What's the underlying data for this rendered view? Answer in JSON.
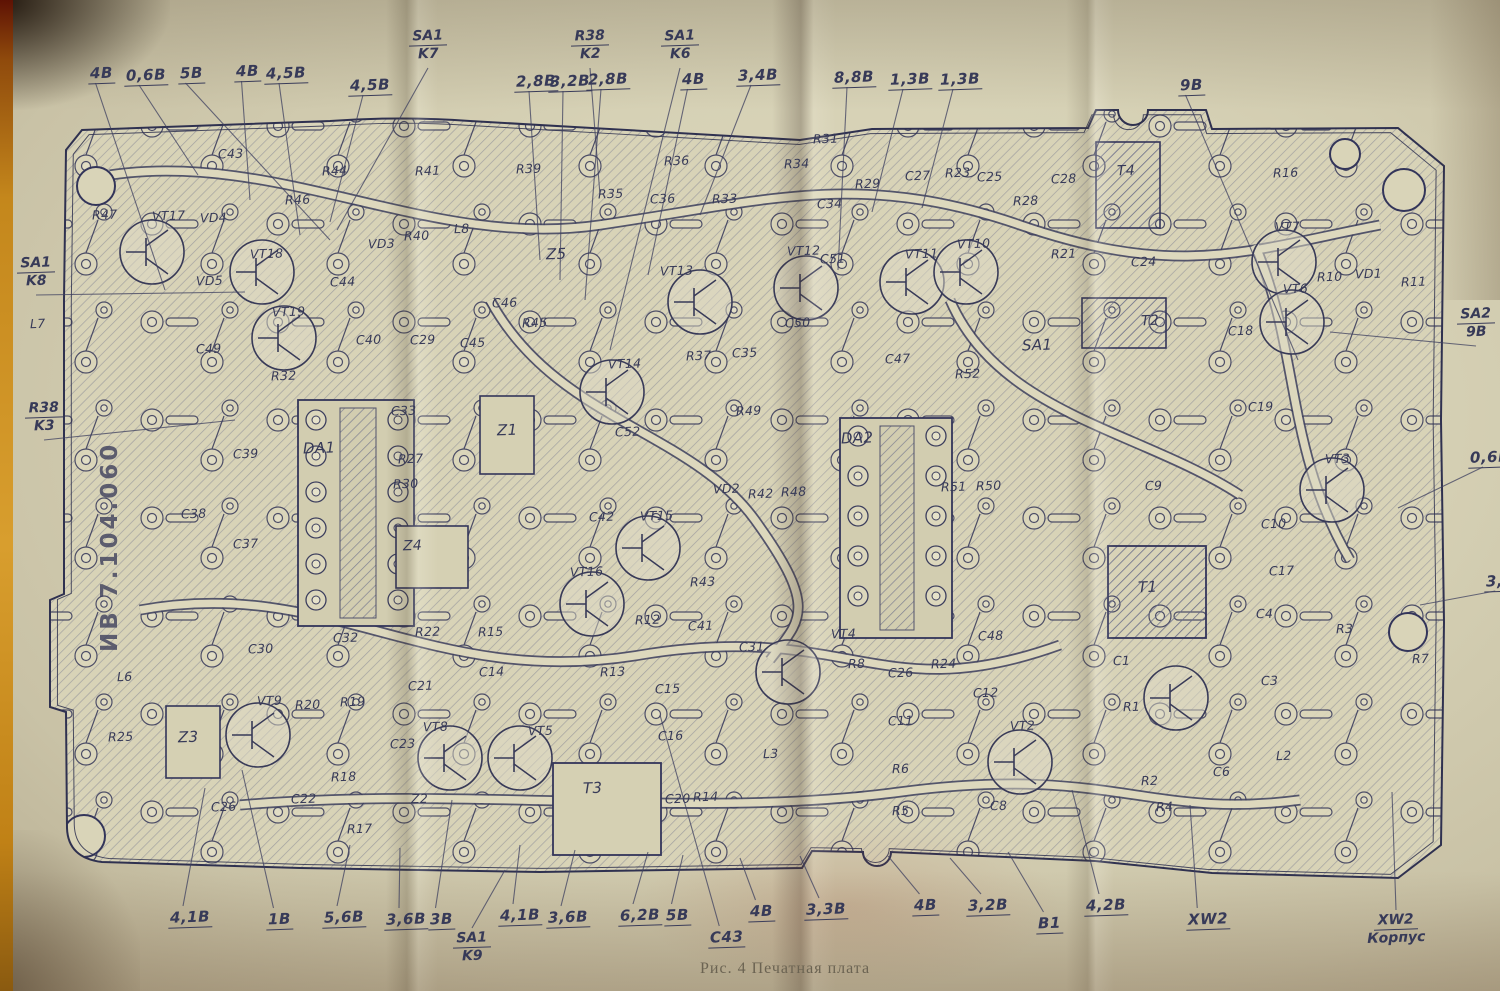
{
  "caption": "Рис. 4 Печатная плата",
  "board_id": "ИВ 7.104.060",
  "colors": {
    "paper": "#d6d0b4",
    "ink": "#373a58",
    "copper_hatch": "#6b6e8a",
    "film_strip_orange": "#c4871c"
  },
  "voltage_labels": [
    {
      "t": "4В",
      "x": 88,
      "y": 64,
      "lx": 165,
      "ly": 290
    },
    {
      "t": "0,6В",
      "x": 124,
      "y": 66,
      "lx": 198,
      "ly": 175
    },
    {
      "t": "5В",
      "x": 178,
      "y": 64,
      "lx": 330,
      "ly": 240
    },
    {
      "t": "4В",
      "x": 234,
      "y": 62,
      "lx": 250,
      "ly": 200
    },
    {
      "t": "4,5В",
      "x": 264,
      "y": 64,
      "lx": 300,
      "ly": 235
    },
    {
      "t": "4,5В",
      "x": 348,
      "y": 76,
      "lx": 330,
      "ly": 222
    },
    {
      "t": "2,8В",
      "x": 514,
      "y": 72,
      "lx": 540,
      "ly": 260
    },
    {
      "t": "3,2В",
      "x": 548,
      "y": 72,
      "lx": 560,
      "ly": 280
    },
    {
      "t": "2,8В",
      "x": 586,
      "y": 70,
      "lx": 585,
      "ly": 300
    },
    {
      "t": "4В",
      "x": 680,
      "y": 70,
      "lx": 648,
      "ly": 275
    },
    {
      "t": "3,4В",
      "x": 736,
      "y": 66,
      "lx": 700,
      "ly": 215
    },
    {
      "t": "8,8В",
      "x": 832,
      "y": 68,
      "lx": 838,
      "ly": 270
    },
    {
      "t": "1,3В",
      "x": 888,
      "y": 70,
      "lx": 872,
      "ly": 212
    },
    {
      "t": "1,3В",
      "x": 938,
      "y": 70,
      "lx": 922,
      "ly": 208
    },
    {
      "t": "9В",
      "x": 1178,
      "y": 76,
      "lx": 1298,
      "ly": 360
    },
    {
      "t": "0,6В",
      "x": 1468,
      "y": 448,
      "lx": 1398,
      "ly": 508
    },
    {
      "t": "3,6",
      "x": 1484,
      "y": 572,
      "lx": 1420,
      "ly": 605
    },
    {
      "t": "4,1В",
      "x": 168,
      "y": 908,
      "lx": 205,
      "ly": 788
    },
    {
      "t": "1В",
      "x": 266,
      "y": 910,
      "lx": 242,
      "ly": 770
    },
    {
      "t": "5,6В",
      "x": 322,
      "y": 908,
      "lx": 350,
      "ly": 845
    },
    {
      "t": "3,6В",
      "x": 384,
      "y": 910,
      "lx": 400,
      "ly": 848
    },
    {
      "t": "3В",
      "x": 428,
      "y": 910,
      "lx": 452,
      "ly": 800
    },
    {
      "t": "4,1В",
      "x": 498,
      "y": 906,
      "lx": 520,
      "ly": 845
    },
    {
      "t": "3,6В",
      "x": 546,
      "y": 908,
      "lx": 575,
      "ly": 850
    },
    {
      "t": "6,2В",
      "x": 618,
      "y": 906,
      "lx": 648,
      "ly": 852
    },
    {
      "t": "5В",
      "x": 664,
      "y": 906,
      "lx": 683,
      "ly": 855
    },
    {
      "t": "C43",
      "x": 708,
      "y": 928,
      "lx": 660,
      "ly": 715
    },
    {
      "t": "4В",
      "x": 748,
      "y": 902,
      "lx": 740,
      "ly": 858
    },
    {
      "t": "3,3В",
      "x": 804,
      "y": 900,
      "lx": 800,
      "ly": 856
    },
    {
      "t": "4В",
      "x": 912,
      "y": 896,
      "lx": 888,
      "ly": 856
    },
    {
      "t": "3,2В",
      "x": 966,
      "y": 896,
      "lx": 950,
      "ly": 858
    },
    {
      "t": "В1",
      "x": 1036,
      "y": 914,
      "lx": 1008,
      "ly": 852
    },
    {
      "t": "4,2В",
      "x": 1084,
      "y": 896,
      "lx": 1072,
      "ly": 790
    },
    {
      "t": "XW2",
      "x": 1186,
      "y": 910,
      "lx": 1190,
      "ly": 805
    }
  ],
  "fraction_labels": [
    {
      "top": "SA1",
      "bottom": "K7",
      "x": 404,
      "y": 28,
      "lx": 337,
      "ly": 230
    },
    {
      "top": "R38",
      "bottom": "K2",
      "x": 566,
      "y": 28,
      "lx": 600,
      "ly": 195
    },
    {
      "top": "SA1",
      "bottom": "K6",
      "x": 656,
      "y": 28,
      "lx": 610,
      "ly": 350
    },
    {
      "top": "SA1",
      "bottom": "K8",
      "x": 12,
      "y": 255,
      "lx": 245,
      "ly": 292
    },
    {
      "top": "R38",
      "bottom": "K3",
      "x": 20,
      "y": 400,
      "lx": 235,
      "ly": 420
    },
    {
      "top": "SA2",
      "bottom": "9В",
      "x": 1452,
      "y": 306,
      "lx": 1330,
      "ly": 332
    },
    {
      "top": "SA1",
      "bottom": "K9",
      "x": 448,
      "y": 930,
      "lx": 505,
      "ly": 870
    },
    {
      "top": "XW2",
      "bottom": "Корпус",
      "x": 1372,
      "y": 912,
      "lx": 1392,
      "ly": 792
    }
  ],
  "component_labels": [
    {
      "t": "C43",
      "x": 218,
      "y": 146
    },
    {
      "t": "R44",
      "x": 322,
      "y": 163
    },
    {
      "t": "R46",
      "x": 285,
      "y": 192
    },
    {
      "t": "R41",
      "x": 415,
      "y": 163
    },
    {
      "t": "R47",
      "x": 92,
      "y": 207
    },
    {
      "t": "VT17",
      "x": 152,
      "y": 208
    },
    {
      "t": "VD4",
      "x": 200,
      "y": 210
    },
    {
      "t": "VT18",
      "x": 250,
      "y": 246
    },
    {
      "t": "VD5",
      "x": 196,
      "y": 273
    },
    {
      "t": "VD3",
      "x": 368,
      "y": 236
    },
    {
      "t": "R40",
      "x": 404,
      "y": 228
    },
    {
      "t": "C44",
      "x": 330,
      "y": 274
    },
    {
      "t": "VT19",
      "x": 272,
      "y": 304
    },
    {
      "t": "C49",
      "x": 196,
      "y": 341
    },
    {
      "t": "C40",
      "x": 356,
      "y": 332
    },
    {
      "t": "C29",
      "x": 410,
      "y": 332
    },
    {
      "t": "R32",
      "x": 271,
      "y": 368
    },
    {
      "t": "L7",
      "x": 30,
      "y": 316
    },
    {
      "t": "R39",
      "x": 516,
      "y": 161
    },
    {
      "t": "R36",
      "x": 664,
      "y": 153
    },
    {
      "t": "R34",
      "x": 784,
      "y": 156
    },
    {
      "t": "R35",
      "x": 598,
      "y": 186
    },
    {
      "t": "C36",
      "x": 650,
      "y": 191
    },
    {
      "t": "R33",
      "x": 712,
      "y": 191
    },
    {
      "t": "L8",
      "x": 454,
      "y": 221
    },
    {
      "t": "Z5",
      "x": 546,
      "y": 245,
      "s": 15
    },
    {
      "t": "VT13",
      "x": 660,
      "y": 263
    },
    {
      "t": "VT12",
      "x": 787,
      "y": 243
    },
    {
      "t": "C46",
      "x": 492,
      "y": 295
    },
    {
      "t": "R45",
      "x": 522,
      "y": 315
    },
    {
      "t": "C45",
      "x": 460,
      "y": 335
    },
    {
      "t": "VT14",
      "x": 608,
      "y": 356
    },
    {
      "t": "R37",
      "x": 686,
      "y": 348
    },
    {
      "t": "C35",
      "x": 732,
      "y": 345
    },
    {
      "t": "C50",
      "x": 785,
      "y": 315
    },
    {
      "t": "R49",
      "x": 736,
      "y": 403
    },
    {
      "t": "R31",
      "x": 813,
      "y": 131
    },
    {
      "t": "R29",
      "x": 855,
      "y": 176
    },
    {
      "t": "C27",
      "x": 905,
      "y": 168
    },
    {
      "t": "R23",
      "x": 945,
      "y": 165
    },
    {
      "t": "C25",
      "x": 977,
      "y": 169
    },
    {
      "t": "C28",
      "x": 1051,
      "y": 171
    },
    {
      "t": "T4",
      "x": 1117,
      "y": 163,
      "s": 14
    },
    {
      "t": "C34",
      "x": 817,
      "y": 196
    },
    {
      "t": "R28",
      "x": 1013,
      "y": 193
    },
    {
      "t": "VT11",
      "x": 905,
      "y": 246
    },
    {
      "t": "VT10",
      "x": 957,
      "y": 236
    },
    {
      "t": "R21",
      "x": 1051,
      "y": 246
    },
    {
      "t": "C51",
      "x": 820,
      "y": 251
    },
    {
      "t": "C24",
      "x": 1131,
      "y": 254
    },
    {
      "t": "T2",
      "x": 1141,
      "y": 313,
      "s": 14
    },
    {
      "t": "SA1",
      "x": 1022,
      "y": 336,
      "s": 15
    },
    {
      "t": "C47",
      "x": 885,
      "y": 351
    },
    {
      "t": "R52",
      "x": 955,
      "y": 366
    },
    {
      "t": "R16",
      "x": 1273,
      "y": 165
    },
    {
      "t": "VT7",
      "x": 1275,
      "y": 219
    },
    {
      "t": "R10",
      "x": 1317,
      "y": 269
    },
    {
      "t": "VD1",
      "x": 1355,
      "y": 266
    },
    {
      "t": "R11",
      "x": 1401,
      "y": 274
    },
    {
      "t": "VT6",
      "x": 1283,
      "y": 281
    },
    {
      "t": "C18",
      "x": 1228,
      "y": 323
    },
    {
      "t": "C33",
      "x": 391,
      "y": 403
    },
    {
      "t": "DA1",
      "x": 303,
      "y": 439,
      "s": 15
    },
    {
      "t": "C39",
      "x": 233,
      "y": 446
    },
    {
      "t": "R27",
      "x": 398,
      "y": 451
    },
    {
      "t": "R30",
      "x": 393,
      "y": 476
    },
    {
      "t": "C38",
      "x": 181,
      "y": 506
    },
    {
      "t": "Z1",
      "x": 497,
      "y": 421,
      "s": 15
    },
    {
      "t": "C37",
      "x": 233,
      "y": 536
    },
    {
      "t": "Z4",
      "x": 403,
      "y": 538,
      "s": 14
    },
    {
      "t": "C52",
      "x": 615,
      "y": 424
    },
    {
      "t": "DA2",
      "x": 841,
      "y": 429,
      "s": 15
    },
    {
      "t": "VD2",
      "x": 713,
      "y": 481
    },
    {
      "t": "R42",
      "x": 748,
      "y": 486
    },
    {
      "t": "R48",
      "x": 781,
      "y": 484
    },
    {
      "t": "C42",
      "x": 589,
      "y": 509
    },
    {
      "t": "VT15",
      "x": 640,
      "y": 508
    },
    {
      "t": "VT16",
      "x": 570,
      "y": 564
    },
    {
      "t": "R43",
      "x": 690,
      "y": 574
    },
    {
      "t": "R12",
      "x": 635,
      "y": 612
    },
    {
      "t": "C41",
      "x": 688,
      "y": 618
    },
    {
      "t": "C31",
      "x": 739,
      "y": 639
    },
    {
      "t": "VT4",
      "x": 831,
      "y": 626
    },
    {
      "t": "R13",
      "x": 600,
      "y": 664
    },
    {
      "t": "C15",
      "x": 655,
      "y": 681
    },
    {
      "t": "C16",
      "x": 658,
      "y": 728
    },
    {
      "t": "R51",
      "x": 941,
      "y": 479
    },
    {
      "t": "R50",
      "x": 976,
      "y": 478
    },
    {
      "t": "C9",
      "x": 1145,
      "y": 478
    },
    {
      "t": "C10",
      "x": 1261,
      "y": 516
    },
    {
      "t": "T1",
      "x": 1138,
      "y": 578,
      "s": 15
    },
    {
      "t": "C19",
      "x": 1248,
      "y": 399
    },
    {
      "t": "VT3",
      "x": 1325,
      "y": 451
    },
    {
      "t": "C17",
      "x": 1269,
      "y": 563
    },
    {
      "t": "C4",
      "x": 1256,
      "y": 606
    },
    {
      "t": "R3",
      "x": 1336,
      "y": 621
    },
    {
      "t": "R7",
      "x": 1412,
      "y": 651
    },
    {
      "t": "C30",
      "x": 248,
      "y": 641
    },
    {
      "t": "C32",
      "x": 333,
      "y": 630
    },
    {
      "t": "R22",
      "x": 415,
      "y": 624
    },
    {
      "t": "R15",
      "x": 478,
      "y": 624
    },
    {
      "t": "C14",
      "x": 479,
      "y": 664
    },
    {
      "t": "L6",
      "x": 117,
      "y": 669
    },
    {
      "t": "R25",
      "x": 108,
      "y": 729
    },
    {
      "t": "Z3",
      "x": 178,
      "y": 728,
      "s": 15
    },
    {
      "t": "VT9",
      "x": 257,
      "y": 693
    },
    {
      "t": "R20",
      "x": 295,
      "y": 697
    },
    {
      "t": "R19",
      "x": 340,
      "y": 694
    },
    {
      "t": "C21",
      "x": 408,
      "y": 678
    },
    {
      "t": "VT8",
      "x": 423,
      "y": 719
    },
    {
      "t": "C23",
      "x": 390,
      "y": 736
    },
    {
      "t": "R18",
      "x": 331,
      "y": 769
    },
    {
      "t": "Z2",
      "x": 411,
      "y": 791
    },
    {
      "t": "C26",
      "x": 211,
      "y": 799
    },
    {
      "t": "C22",
      "x": 291,
      "y": 791
    },
    {
      "t": "R17",
      "x": 347,
      "y": 821
    },
    {
      "t": "VT5",
      "x": 528,
      "y": 723
    },
    {
      "t": "T3",
      "x": 583,
      "y": 779,
      "s": 15
    },
    {
      "t": "C20",
      "x": 665,
      "y": 791
    },
    {
      "t": "R14",
      "x": 693,
      "y": 789
    },
    {
      "t": "L3",
      "x": 763,
      "y": 746
    },
    {
      "t": "R8",
      "x": 848,
      "y": 656
    },
    {
      "t": "C26",
      "x": 888,
      "y": 665
    },
    {
      "t": "C11",
      "x": 888,
      "y": 713
    },
    {
      "t": "R6",
      "x": 892,
      "y": 761
    },
    {
      "t": "R5",
      "x": 892,
      "y": 803
    },
    {
      "t": "C8",
      "x": 990,
      "y": 798
    },
    {
      "t": "C48",
      "x": 978,
      "y": 628
    },
    {
      "t": "R24",
      "x": 931,
      "y": 656
    },
    {
      "t": "C12",
      "x": 973,
      "y": 685
    },
    {
      "t": "VT2",
      "x": 1010,
      "y": 718
    },
    {
      "t": "C1",
      "x": 1113,
      "y": 653
    },
    {
      "t": "R1",
      "x": 1123,
      "y": 699
    },
    {
      "t": "R2",
      "x": 1141,
      "y": 773
    },
    {
      "t": "R4",
      "x": 1156,
      "y": 799
    },
    {
      "t": "C6",
      "x": 1213,
      "y": 764
    },
    {
      "t": "L2",
      "x": 1276,
      "y": 748
    },
    {
      "t": "C3",
      "x": 1261,
      "y": 673
    }
  ]
}
